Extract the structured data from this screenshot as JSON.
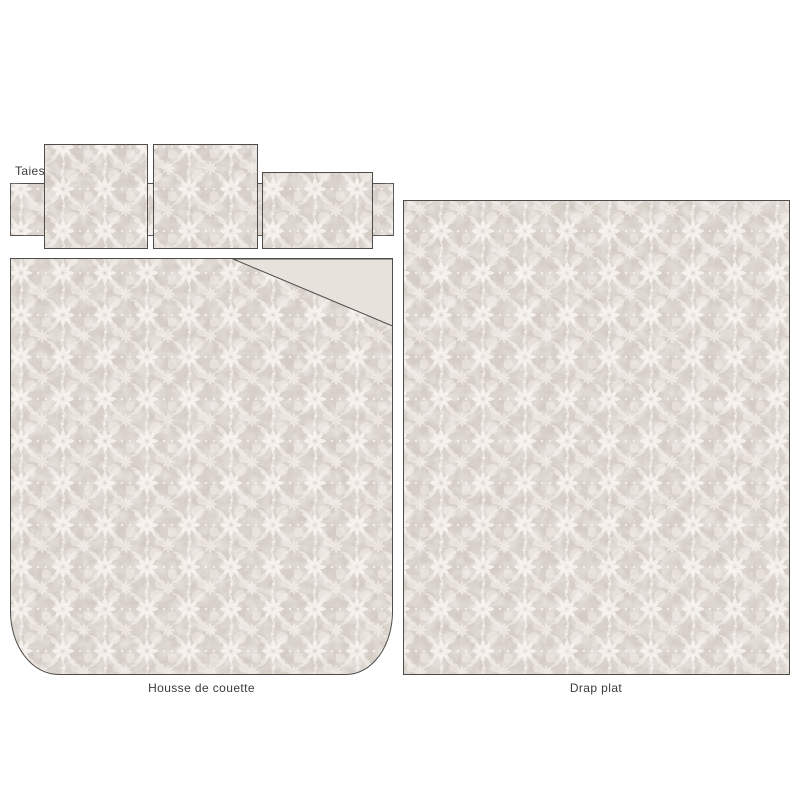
{
  "diagram": {
    "description_labels": {
      "pillowcases": "Taies",
      "duvet_cover": "Housse de couette",
      "flat_sheet": "Drap plat"
    },
    "pieces": [
      {
        "name": "pillowcase-band-with-flaps",
        "label_ref": "Taies"
      },
      {
        "name": "square-pillowcase-1",
        "label_ref": "Taies"
      },
      {
        "name": "square-pillowcase-2",
        "label_ref": "Taies"
      },
      {
        "name": "rectangular-pillowcase",
        "label_ref": "Taies"
      },
      {
        "name": "duvet-cover",
        "label_ref": "Housse de couette"
      },
      {
        "name": "flat-sheet",
        "label_ref": "Drap plat"
      }
    ],
    "colors": {
      "fabric_base": "#d8d1ca",
      "fabric_motif_white": "#f6f2ee",
      "fabric_motif_soft": "#ece5df",
      "fabric_shade": "#cdc4bd",
      "fold_plain": "#e8e2dc",
      "outline": "#4f4d4c",
      "label_text": "#3d3b3a",
      "page_background": "#ffffff"
    }
  }
}
